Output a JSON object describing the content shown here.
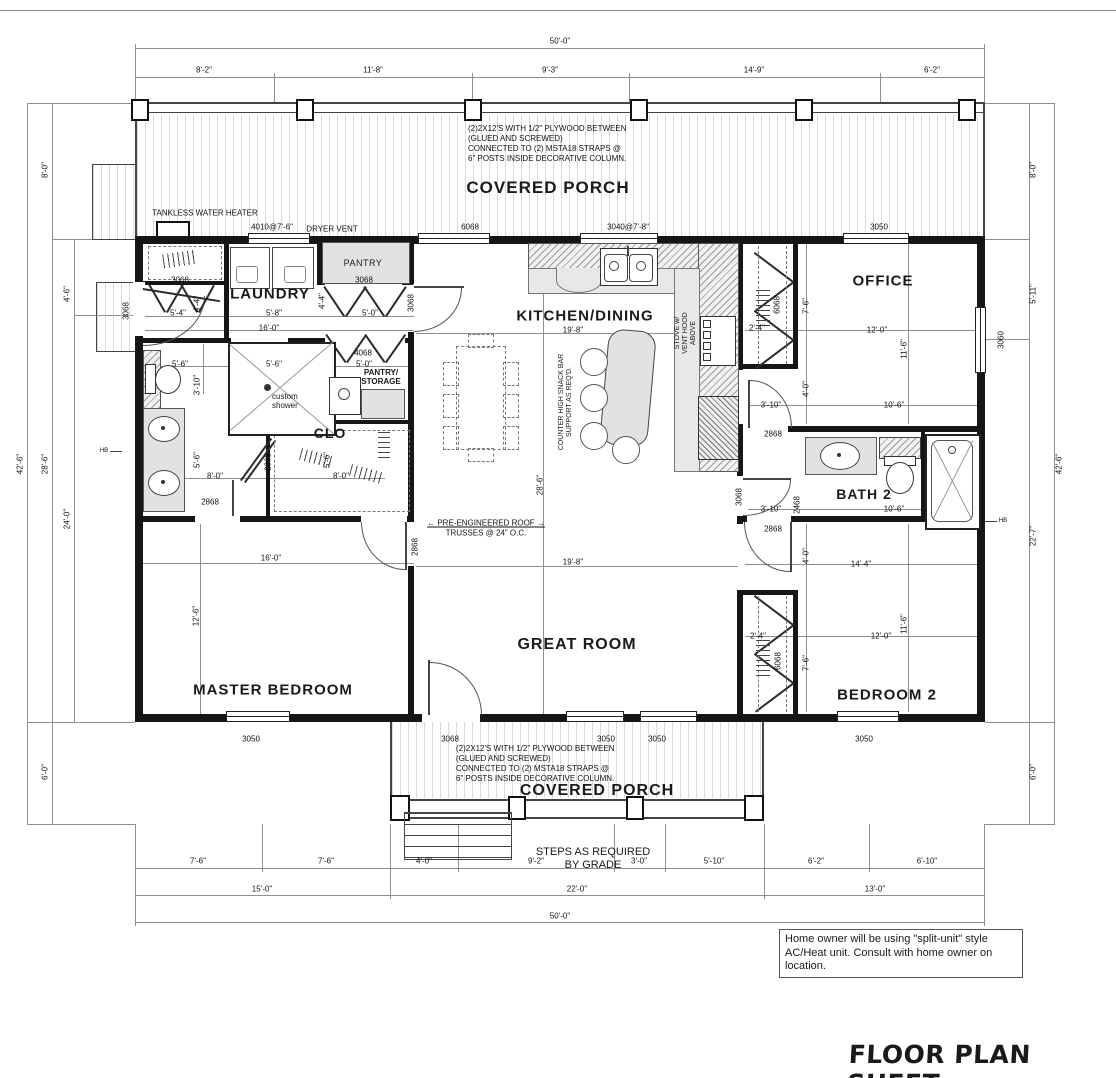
{
  "sheet": {
    "title": "FLOOR PLAN SHEET"
  },
  "rooms": {
    "covered_porch_top": "COVERED PORCH",
    "covered_porch_bottom": "COVERED PORCH",
    "laundry": "LAUNDRY",
    "pantry": "PANTRY",
    "kitchen_dining": "KITCHEN/DINING",
    "office": "OFFICE",
    "pantry_storage": "PANTRY/\nSTORAGE",
    "clo": "CLO",
    "bath2": "BATH 2",
    "master_bedroom": "MASTER BEDROOM",
    "great_room": "GREAT ROOM",
    "bedroom2": "BEDROOM 2",
    "custom_shower": "custom\nshower"
  },
  "notes": {
    "porch_construction": "(2)2X12'S WITH 1/2\" PLYWOOD BETWEEN\n(GLUED AND SCREWED)\nCONNECTED TO (2) MSTA18 STRAPS @\n6\" POSTS INSIDE DECORATIVE COLUMN.",
    "ac_unit": "Home owner will be using \"split-unit\" style\nAC/Heat unit. Consult with home owner on\nlocation.",
    "steps": "STEPS AS REQUIRED\nBY GRADE",
    "trusses_line1": "PRE-ENGINEERED ROOF",
    "trusses_line2": "TRUSSES @ 24\" O.C.",
    "tankless": "TANKLESS WATER HEATER",
    "dryer_vent": "DRYER VENT",
    "stove": "STOVE w/\nVENT HOOD\nABOVE",
    "snack_bar": "COUNTER HIGH SNACK BAR\nSUPPORT AS REQ'D.",
    "hose_bib": "HB"
  },
  "dim_labels": [
    {
      "t": "50'-0\"",
      "x": 560,
      "y": 41
    },
    {
      "t": "8'-2\"",
      "x": 204,
      "y": 70
    },
    {
      "t": "11'-8\"",
      "x": 373,
      "y": 70
    },
    {
      "t": "9'-3\"",
      "x": 550,
      "y": 70
    },
    {
      "t": "14'-9\"",
      "x": 754,
      "y": 70
    },
    {
      "t": "6'-2\"",
      "x": 932,
      "y": 70
    },
    {
      "t": "4010@7'-6\"",
      "x": 272,
      "y": 227
    },
    {
      "t": "6068",
      "x": 470,
      "y": 227
    },
    {
      "t": "3040@7'-8\"",
      "x": 628,
      "y": 227
    },
    {
      "t": "3050",
      "x": 879,
      "y": 227
    },
    {
      "t": "42'-6\"",
      "x": 20,
      "y": 464,
      "r": 1
    },
    {
      "t": "28'-6\"",
      "x": 45,
      "y": 464,
      "r": 1
    },
    {
      "t": "8'-0\"",
      "x": 45,
      "y": 170,
      "r": 1
    },
    {
      "t": "6'-0\"",
      "x": 45,
      "y": 772,
      "r": 1
    },
    {
      "t": "4'-6\"",
      "x": 67,
      "y": 294,
      "r": 1
    },
    {
      "t": "24'-0\"",
      "x": 67,
      "y": 519,
      "r": 1
    },
    {
      "t": "3068",
      "x": 126,
      "y": 311,
      "r": 1
    },
    {
      "t": "42'-6\"",
      "x": 1059,
      "y": 464,
      "r": 1
    },
    {
      "t": "8'-0\"",
      "x": 1033,
      "y": 170,
      "r": 1
    },
    {
      "t": "5'-11\"",
      "x": 1033,
      "y": 294,
      "r": 1
    },
    {
      "t": "22'-7\"",
      "x": 1033,
      "y": 536,
      "r": 1
    },
    {
      "t": "6'-0\"",
      "x": 1033,
      "y": 772,
      "r": 1
    },
    {
      "t": "3060",
      "x": 1001,
      "y": 340,
      "r": 1
    },
    {
      "t": "3050",
      "x": 251,
      "y": 739
    },
    {
      "t": "3068",
      "x": 450,
      "y": 739
    },
    {
      "t": "3050",
      "x": 606,
      "y": 739
    },
    {
      "t": "3050",
      "x": 657,
      "y": 739
    },
    {
      "t": "3050",
      "x": 864,
      "y": 739
    },
    {
      "t": "7'-6\"",
      "x": 198,
      "y": 861
    },
    {
      "t": "7'-6\"",
      "x": 326,
      "y": 861
    },
    {
      "t": "4'-0\"",
      "x": 424,
      "y": 861
    },
    {
      "t": "9'-2\"",
      "x": 536,
      "y": 861
    },
    {
      "t": "3'-0\"",
      "x": 639,
      "y": 861
    },
    {
      "t": "5'-10\"",
      "x": 714,
      "y": 861
    },
    {
      "t": "6'-2\"",
      "x": 816,
      "y": 861
    },
    {
      "t": "6'-10\"",
      "x": 927,
      "y": 861
    },
    {
      "t": "15'-0\"",
      "x": 262,
      "y": 889
    },
    {
      "t": "22'-0\"",
      "x": 577,
      "y": 889
    },
    {
      "t": "13'-0\"",
      "x": 875,
      "y": 889
    },
    {
      "t": "50'-0\"",
      "x": 560,
      "y": 916
    },
    {
      "t": "3068",
      "x": 180,
      "y": 280
    },
    {
      "t": "3068",
      "x": 364,
      "y": 280
    },
    {
      "t": "3068",
      "x": 411,
      "y": 303,
      "r": 1
    },
    {
      "t": "4'-4\"",
      "x": 322,
      "y": 301,
      "r": 1
    },
    {
      "t": "4'-4\"",
      "x": 197,
      "y": 304,
      "r": 1
    },
    {
      "t": "5'-4\"",
      "x": 178,
      "y": 313
    },
    {
      "t": "5'-8\"",
      "x": 274,
      "y": 313
    },
    {
      "t": "5'-0\"",
      "x": 370,
      "y": 313
    },
    {
      "t": "16'-0\"",
      "x": 269,
      "y": 328
    },
    {
      "t": "4068",
      "x": 363,
      "y": 353
    },
    {
      "t": "5'-6\"",
      "x": 180,
      "y": 364
    },
    {
      "t": "5'-6\"",
      "x": 274,
      "y": 364
    },
    {
      "t": "5'-0\"",
      "x": 364,
      "y": 364
    },
    {
      "t": "3'-10\"",
      "x": 197,
      "y": 385,
      "r": 1
    },
    {
      "t": "5'-6\"",
      "x": 197,
      "y": 460,
      "r": 1
    },
    {
      "t": "8'-0\"",
      "x": 215,
      "y": 476
    },
    {
      "t": "5'-6\"",
      "x": 327,
      "y": 460,
      "r": 1
    },
    {
      "t": "8'-0\"",
      "x": 341,
      "y": 476
    },
    {
      "t": "2868",
      "x": 268,
      "y": 462,
      "r": 1
    },
    {
      "t": "2868",
      "x": 210,
      "y": 502
    },
    {
      "t": "2868",
      "x": 415,
      "y": 547,
      "r": 1
    },
    {
      "t": "19'-8\"",
      "x": 573,
      "y": 330
    },
    {
      "t": "28'-6\"",
      "x": 540,
      "y": 485,
      "r": 1
    },
    {
      "t": "19'-8\"",
      "x": 573,
      "y": 562
    },
    {
      "t": "2'-4\"",
      "x": 757,
      "y": 328
    },
    {
      "t": "6068",
      "x": 777,
      "y": 305,
      "r": 1
    },
    {
      "t": "7'-6\"",
      "x": 806,
      "y": 306,
      "r": 1
    },
    {
      "t": "12'-0\"",
      "x": 877,
      "y": 330
    },
    {
      "t": "11'-6\"",
      "x": 904,
      "y": 349,
      "r": 1
    },
    {
      "t": "4'-0\"",
      "x": 806,
      "y": 389,
      "r": 1
    },
    {
      "t": "3'-10\"",
      "x": 771,
      "y": 405
    },
    {
      "t": "10'-6\"",
      "x": 894,
      "y": 405
    },
    {
      "t": "2868",
      "x": 773,
      "y": 434
    },
    {
      "t": "3068",
      "x": 739,
      "y": 497,
      "r": 1
    },
    {
      "t": "2468",
      "x": 797,
      "y": 505,
      "r": 1
    },
    {
      "t": "3'-10\"",
      "x": 771,
      "y": 509
    },
    {
      "t": "10'-6\"",
      "x": 894,
      "y": 509
    },
    {
      "t": "2868",
      "x": 773,
      "y": 529
    },
    {
      "t": "4'-0\"",
      "x": 806,
      "y": 556,
      "r": 1
    },
    {
      "t": "14'-4\"",
      "x": 861,
      "y": 564
    },
    {
      "t": "2'-4\"",
      "x": 758,
      "y": 636
    },
    {
      "t": "6068",
      "x": 778,
      "y": 661,
      "r": 1
    },
    {
      "t": "7'-6\"",
      "x": 806,
      "y": 663,
      "r": 1
    },
    {
      "t": "12'-0\"",
      "x": 881,
      "y": 636
    },
    {
      "t": "11'-6\"",
      "x": 904,
      "y": 624,
      "r": 1
    },
    {
      "t": "16'-0\"",
      "x": 271,
      "y": 558
    },
    {
      "t": "12'-6\"",
      "x": 196,
      "y": 616,
      "r": 1
    }
  ]
}
